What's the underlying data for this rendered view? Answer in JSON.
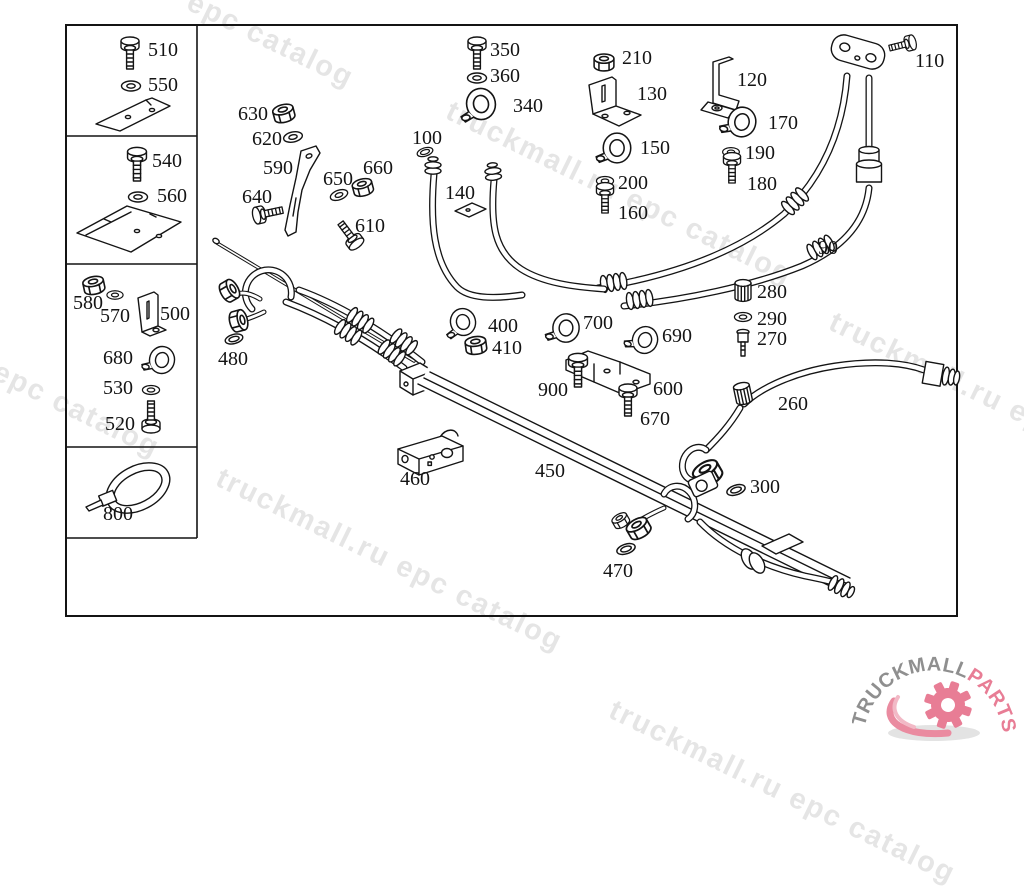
{
  "page": {
    "background": "#ffffff",
    "line_color": "#141414",
    "watermark_color": "#e5e5e5"
  },
  "watermarks": [
    "epc catalog",
    "truckmall.ru epc catalog",
    "truckmall.ru epc catalog",
    "truckmall.ru epc catalog",
    "truckmall.ru epc catalog",
    "truckmall.ru epc catalog"
  ],
  "logo": {
    "brand": "TRUCKMALL",
    "suffix": "PARTS",
    "brand_color": "#8f8f8f",
    "accent_color": "#e87d95"
  },
  "parts_labels": {
    "90": "90",
    "100": "100",
    "110": "110",
    "120": "120",
    "130": "130",
    "140": "140",
    "150": "150",
    "160": "160",
    "170": "170",
    "180": "180",
    "190": "190",
    "200": "200",
    "210": "210",
    "260": "260",
    "270": "270",
    "280": "280",
    "290": "290",
    "300": "300",
    "340": "340",
    "350": "350",
    "360": "360",
    "400": "400",
    "410": "410",
    "450": "450",
    "460": "460",
    "470": "470",
    "480": "480",
    "500": "500",
    "510": "510",
    "520": "520",
    "530": "530",
    "540": "540",
    "550": "550",
    "560": "560",
    "570": "570",
    "580": "580",
    "590": "590",
    "600": "600",
    "610": "610",
    "620": "620",
    "630": "630",
    "640": "640",
    "650": "650",
    "660": "660",
    "670": "670",
    "680": "680",
    "690": "690",
    "700": "700",
    "800": "800",
    "900": "900"
  }
}
